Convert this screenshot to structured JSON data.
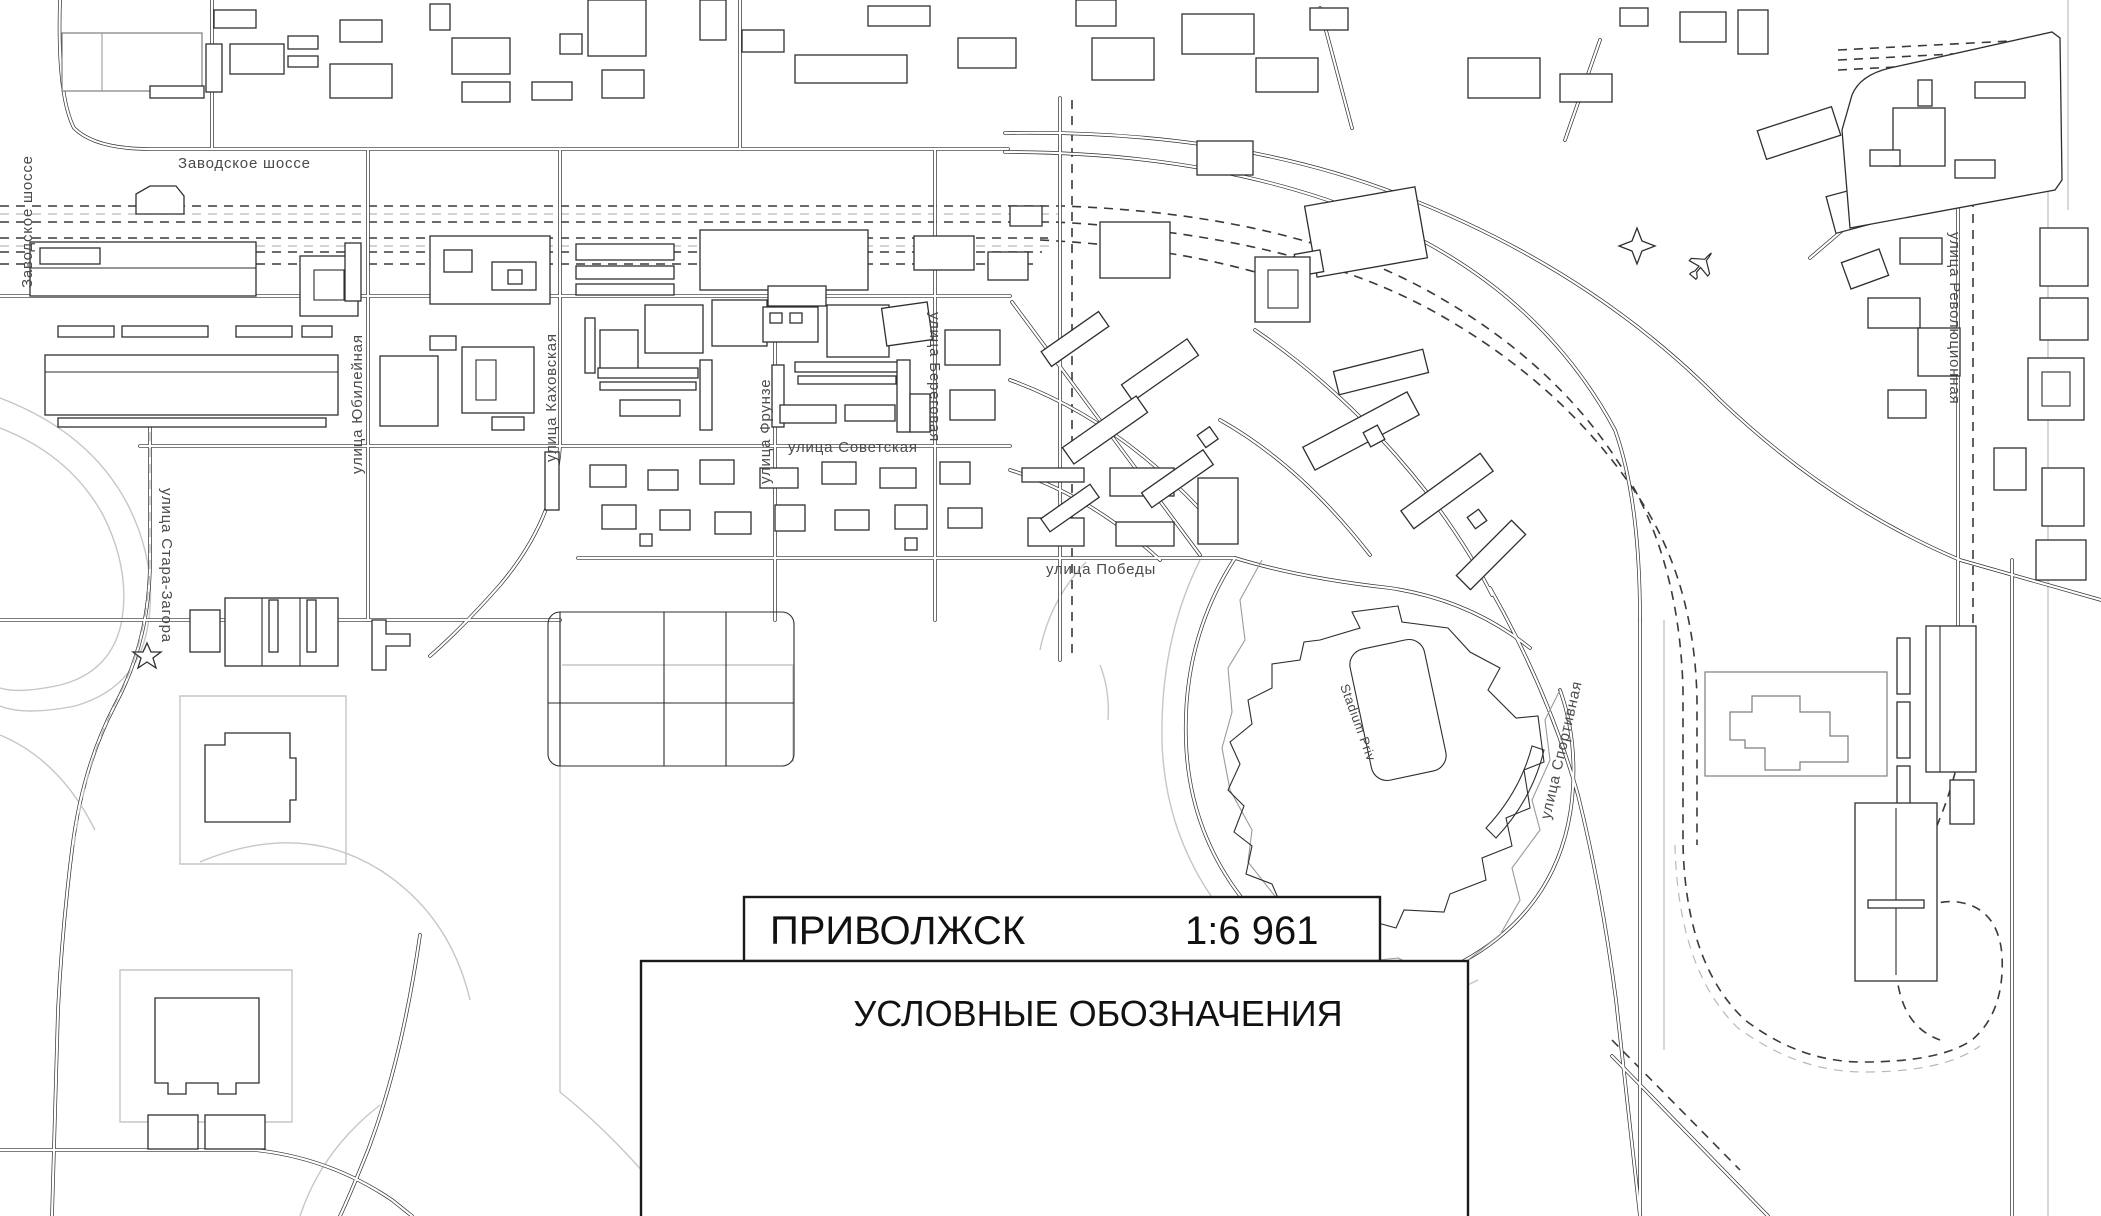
{
  "map": {
    "city_name": "ПРИВОЛЖСК",
    "scale": "1:6 961",
    "legend_title": "УСЛОВНЫЕ ОБОЗНАЧЕНИЯ",
    "stadium_label": "Stadium Priv",
    "streets": [
      {
        "id": "zavodskoe-shosse-top",
        "name": "Заводское шоссе"
      },
      {
        "id": "zavodskoe-shosse-left",
        "name": "Заводское шоссе"
      },
      {
        "id": "yubileynaya",
        "name": "улица Юбилейная"
      },
      {
        "id": "kakhovskaya",
        "name": "улица Каховская"
      },
      {
        "id": "frunze",
        "name": "улица Фрунзе"
      },
      {
        "id": "beregovaya",
        "name": "улица Береговая"
      },
      {
        "id": "sovetskaya",
        "name": "улица Советская"
      },
      {
        "id": "pobedy",
        "name": "улица Победы"
      },
      {
        "id": "stara-zagora",
        "name": "улица Стара-Загора"
      },
      {
        "id": "sportivnaya",
        "name": "улица Спортивная"
      },
      {
        "id": "revolyutsionnaya",
        "name": "улица Революционная"
      }
    ],
    "icons": {
      "star5": "star-icon",
      "star4": "star-icon",
      "airplane": "airplane-icon"
    },
    "colors": {
      "line": "#2e2e2e",
      "light_line": "#c6c6c6",
      "background": "#ffffff"
    }
  }
}
